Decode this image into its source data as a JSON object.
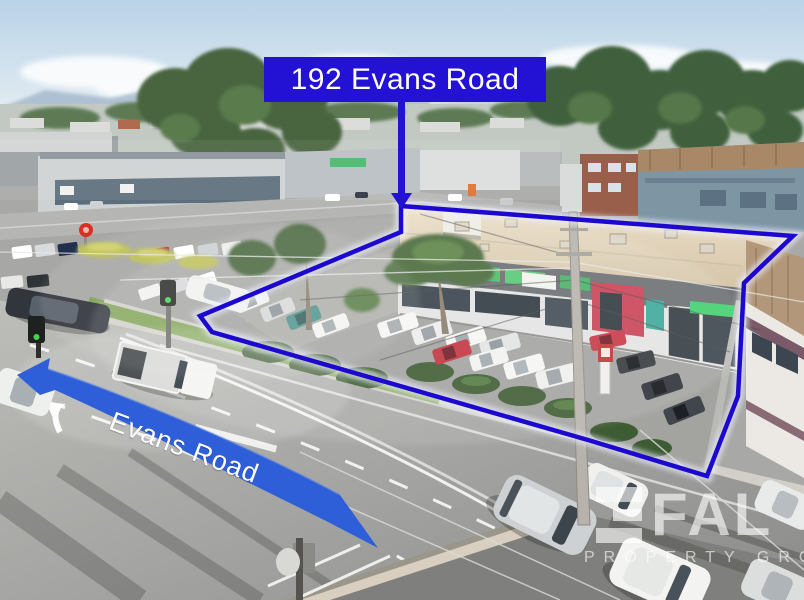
{
  "annotations": {
    "address_label": "192 Evans Road",
    "road_ribbon_label": "Evans Road"
  },
  "watermark": {
    "brand": "FAL",
    "tagline": "PROPERTY GROUP"
  },
  "colors": {
    "label_blue": "#2311d4",
    "outline_blue": "#1d08d0",
    "outline_glow": "#eef2ff",
    "ribbon_blue": "#2e5fd9",
    "text_white": "#ffffff"
  }
}
